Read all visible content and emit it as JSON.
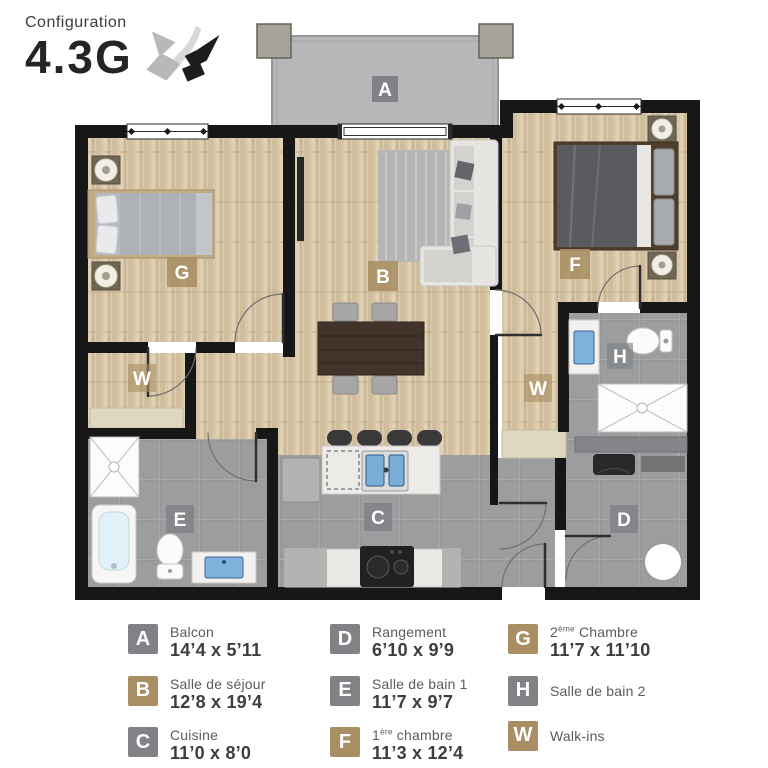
{
  "header": {
    "label": "Configuration",
    "code": "4.3G"
  },
  "colors": {
    "tan": "#a98e63",
    "gray": "#808285",
    "wall": "#171717",
    "wood_floor": "#d8c7a9",
    "tile_floor": "#9c9d9e",
    "balcony": "#b6b7b9",
    "closet_shelf": "#ded8c0",
    "sink_blue": "#7fb3de"
  },
  "plan": {
    "labels": {
      "A": "A",
      "B": "B",
      "C": "C",
      "D": "D",
      "E": "E",
      "F": "F",
      "G": "G",
      "H": "H",
      "W": "W"
    }
  },
  "legend": {
    "items": [
      {
        "letter": "A",
        "tone": "gray",
        "name_pre": "Balcon",
        "name_sup": "",
        "name_post": "",
        "dims": "14’4 x 5’11"
      },
      {
        "letter": "B",
        "tone": "tan",
        "name_pre": "Salle de séjour",
        "name_sup": "",
        "name_post": "",
        "dims": "12’8 x 19’4"
      },
      {
        "letter": "C",
        "tone": "gray",
        "name_pre": "Cuisine",
        "name_sup": "",
        "name_post": "",
        "dims": "11’0 x 8’0"
      },
      {
        "letter": "D",
        "tone": "gray",
        "name_pre": "Rangement",
        "name_sup": "",
        "name_post": "",
        "dims": "6’10 x 9’9"
      },
      {
        "letter": "E",
        "tone": "gray",
        "name_pre": "Salle de bain 1",
        "name_sup": "",
        "name_post": "",
        "dims": "11’7 x 9’7"
      },
      {
        "letter": "F",
        "tone": "tan",
        "name_pre": "1",
        "name_sup": "ère",
        "name_post": " chambre",
        "dims": "11’3 x 12’4"
      },
      {
        "letter": "G",
        "tone": "tan",
        "name_pre": "2",
        "name_sup": "ème",
        "name_post": " Chambre",
        "dims": "11’7 x 11’10"
      },
      {
        "letter": "H",
        "tone": "gray",
        "name_pre": "Salle de bain 2",
        "name_sup": "",
        "name_post": "",
        "dims": ""
      },
      {
        "letter": "W",
        "tone": "tan",
        "name_pre": "Walk-ins",
        "name_sup": "",
        "name_post": "",
        "dims": ""
      }
    ]
  }
}
